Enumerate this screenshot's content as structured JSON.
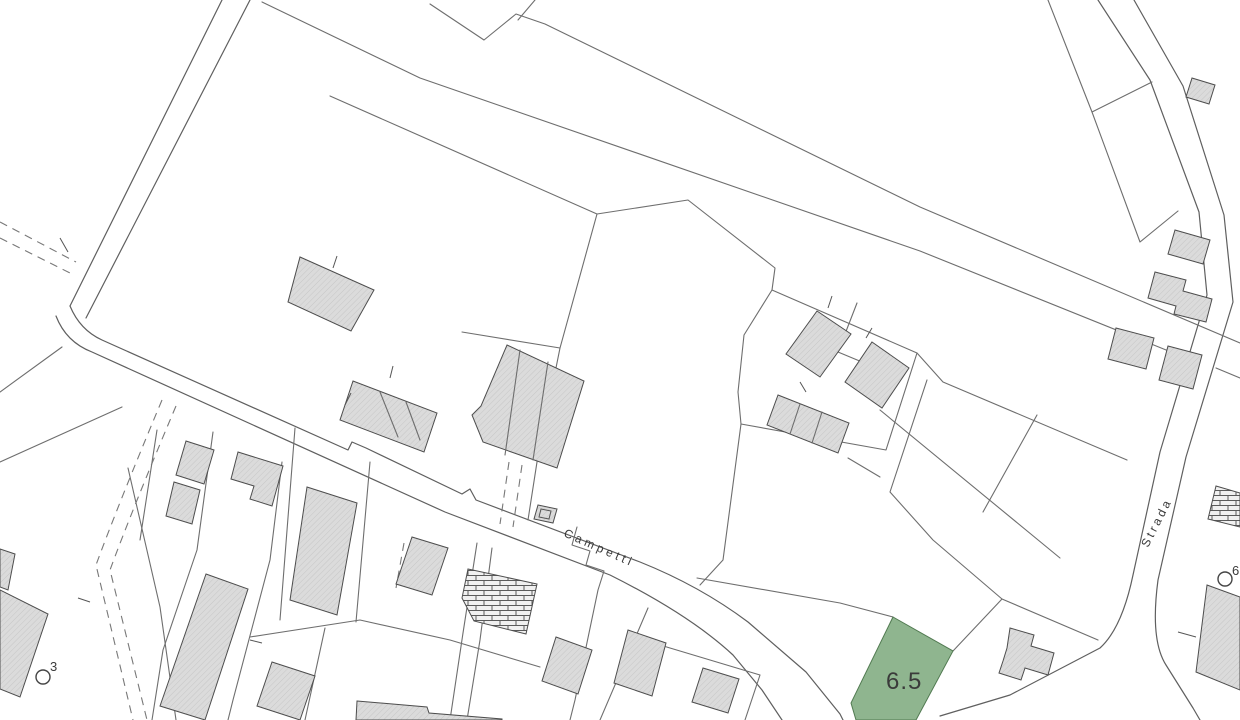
{
  "map": {
    "street_labels": [
      {
        "text": "Campetti"
      },
      {
        "text": "Strada"
      }
    ],
    "highlighted_parcel": {
      "label": "6.5",
      "fill": "#8fb58f",
      "stroke": "#517a51"
    },
    "survey_markers": [
      {
        "label": "3"
      },
      {
        "label": "6"
      }
    ],
    "colors": {
      "background": "#ffffff",
      "parcel_line": "#6e6e6e",
      "building_fill": "#dbdbdb",
      "building_hatch": "#c6c6c6",
      "building_stroke": "#4d4d4d",
      "label_text": "#3a3a3a"
    }
  }
}
